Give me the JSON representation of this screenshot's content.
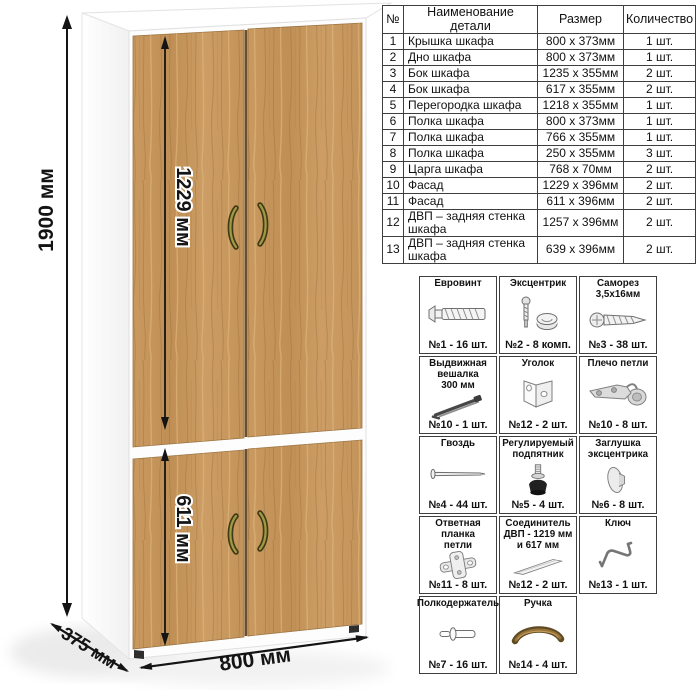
{
  "illustration": {
    "dims": {
      "height": "1900 мм",
      "door_upper": "1229 мм",
      "door_lower": "611 мм",
      "width": "800 мм",
      "depth": "375 мм"
    },
    "colors": {
      "wood": "#c4955c",
      "wood_grain_dark": "#9a7240",
      "wood_grain_light": "#ddb67e",
      "carcass": "#ffffff",
      "handle": "#8a7d35",
      "dimension_line": "#141414",
      "table_border": "#3e3e3e"
    }
  },
  "parts_table": {
    "headers": [
      "№",
      "Наименование детали",
      "Размер",
      "Количество"
    ],
    "rows": [
      [
        "1",
        "Крышка шкафа",
        "800 х 373мм",
        "1 шт."
      ],
      [
        "2",
        "Дно шкафа",
        "800 х 373мм",
        "1 шт."
      ],
      [
        "3",
        "Бок шкафа",
        "1235 х 355мм",
        "2 шт."
      ],
      [
        "4",
        "Бок шкафа",
        "617 х 355мм",
        "2 шт."
      ],
      [
        "5",
        "Перегородка шкафа",
        "1218 х 355мм",
        "1 шт."
      ],
      [
        "6",
        "Полка шкафа",
        "800 х 373мм",
        "1 шт."
      ],
      [
        "7",
        "Полка шкафа",
        "766 х 355мм",
        "1 шт."
      ],
      [
        "8",
        "Полка шкафа",
        "250 х 355мм",
        "3 шт."
      ],
      [
        "9",
        "Царга шкафа",
        "768 х 70мм",
        "2 шт."
      ],
      [
        "10",
        "Фасад",
        "1229 х 396мм",
        "2 шт."
      ],
      [
        "11",
        "Фасад",
        "611 х 396мм",
        "2 шт."
      ],
      [
        "12",
        "ДВП – задняя стенка шкафа",
        "1257 х 396мм",
        "2 шт."
      ],
      [
        "13",
        "ДВП – задняя стенка шкафа",
        "639 х 396мм",
        "2 шт."
      ]
    ]
  },
  "hardware": {
    "items": [
      {
        "title": "Евровинт",
        "qty": "№1 - 16 шт.",
        "icon": "euro-screw-icon"
      },
      {
        "title": "Эксцентрик",
        "qty": "№2 - 8 комп.",
        "icon": "eccentric-cam-icon"
      },
      {
        "title": "Саморез\n3,5х16мм",
        "qty": "№3 - 38 шт.",
        "icon": "self-tapping-screw-icon"
      },
      {
        "title": "Выдвижная\nвешалка\n300 мм",
        "qty": "№10 - 1 шт.",
        "icon": "pullout-hanger-icon"
      },
      {
        "title": "Уголок",
        "qty": "№12 - 2 шт.",
        "icon": "corner-bracket-icon"
      },
      {
        "title": "Плечо петли",
        "qty": "№10 - 8 шт.",
        "icon": "hinge-arm-icon"
      },
      {
        "title": "Гвоздь",
        "qty": "№4 - 44 шт.",
        "icon": "nail-icon"
      },
      {
        "title": "Регулируемый\nподпятник",
        "qty": "№5 - 4 шт.",
        "icon": "adjustable-foot-icon"
      },
      {
        "title": "Заглушка\nэксцентрика",
        "qty": "№6 - 8 шт.",
        "icon": "cam-cap-icon"
      },
      {
        "title": "Ответная планка\nпетли",
        "qty": "№11 - 8 шт.",
        "icon": "hinge-plate-icon"
      },
      {
        "title": "Соединитель\nДВП - 1219 мм\nи 617 мм",
        "qty": "№12 - 2 шт.",
        "icon": "hdf-connector-icon"
      },
      {
        "title": "Ключ",
        "qty": "№13 - 1 шт.",
        "icon": "hex-key-icon"
      },
      {
        "title": "Полкодержатель",
        "qty": "№7 - 16 шт.",
        "icon": "shelf-pin-icon"
      },
      {
        "title": "Ручка",
        "qty": "№14 - 4 шт.",
        "icon": "handle-icon"
      }
    ]
  }
}
